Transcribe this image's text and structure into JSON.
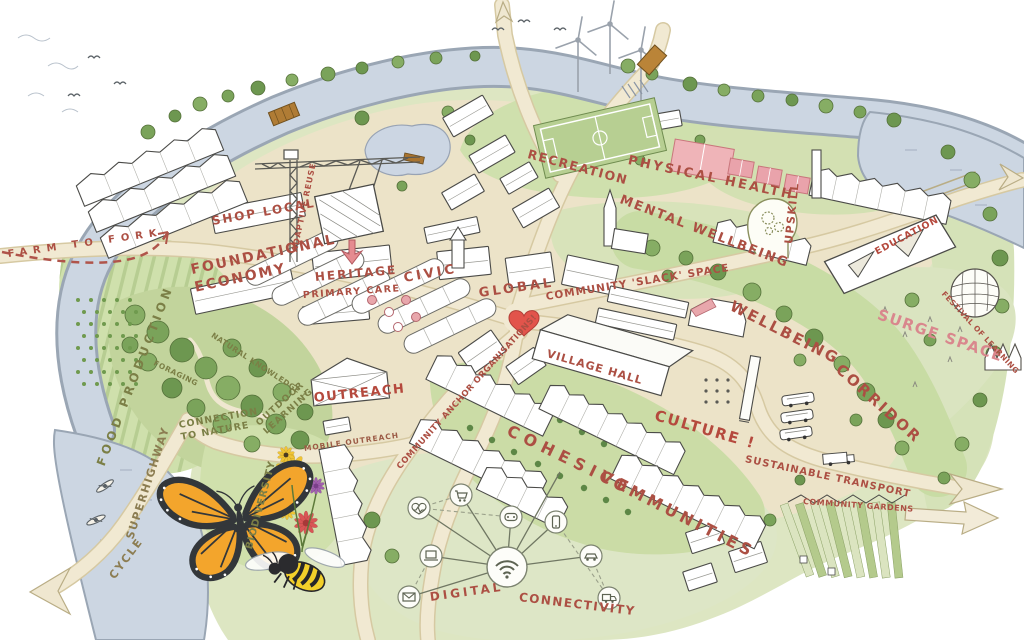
{
  "labels": {
    "farm_to_fork": {
      "text": "FARM TO FORK"
    },
    "food_production": {
      "text": "FOOD PRODUCTION"
    },
    "foundational_economy": {
      "line1": "FOUNDATIONAL",
      "line2": "ECONOMY"
    },
    "shop_local": {
      "text": "SHOP LOCAL"
    },
    "adaptive_reuse": {
      "text": "ADAPTIVE REUSE"
    },
    "heritage": {
      "text": "HERITAGE"
    },
    "primary_care": {
      "text": "PRIMARY CARE"
    },
    "civic": {
      "text": "CIVIC"
    },
    "global": {
      "text": "GLOBAL"
    },
    "community_slack_space": {
      "text": "COMMUNITY 'SLACK' SPACE"
    },
    "recreation": {
      "text": "RECREATION"
    },
    "physical_health": {
      "text": "PHYSICAL HEALTH"
    },
    "mental_wellbeing": {
      "text": "MENTAL WELLBEING"
    },
    "upskill": {
      "text": "UPSKILL"
    },
    "education": {
      "text": "EDUCATION"
    },
    "surge_space": {
      "text": "SURGE SPACE"
    },
    "festival_of_learning": {
      "text": "FESTIVAL OF LEARNING"
    },
    "wellbeing_corridor": {
      "word1": "WELLBEING",
      "word2": "CORRIDOR"
    },
    "culture": {
      "text": "CULTURE !"
    },
    "sustainable_transport": {
      "text": "SUSTAINABLE TRANSPORT"
    },
    "community_gardens": {
      "text": "COMMUNITY GARDENS"
    },
    "village_hall": {
      "text": "VILLAGE HALL"
    },
    "community_anchor_organisations": {
      "text": "COMMUNITY ANCHOR ORGANISATIONS!"
    },
    "cohesive_communities": {
      "word1": "COHESIVE",
      "word2": "COMMUNITIES"
    },
    "outreach": {
      "text": "OUTREACH"
    },
    "mobile_outreach": {
      "text": "MOBILE OUTREACH"
    },
    "outdoor_learning": {
      "line1": "OUTDOOR",
      "line2": "LEARNING"
    },
    "connection_to_nature": {
      "line1": "CONNECTION",
      "line2": "TO NATURE"
    },
    "natural_knowledge": {
      "text": "NATURAL KNOWLEDGE ?"
    },
    "foraging": {
      "text": "FORAGING"
    },
    "biodiversity": {
      "text": "BIODIVERSITY"
    },
    "cycle_superhighway": {
      "word1": "CYCLE",
      "word2": "SUPERHIGHWAY"
    },
    "digital_connectivity": {
      "word1": "DIGITAL",
      "word2": "CONNECTIVITY"
    }
  },
  "palette": {
    "label_red": "#ac4f43",
    "label_pink": "#d9878d",
    "label_olive": "#7b7f46",
    "label_tan": "#8c7d52",
    "river": "#ccd6e2",
    "land": "#ece3c8",
    "grass": "#d5e1b8",
    "woodland": "#6f9850",
    "court_pink": "#efb4b8",
    "heart_red": "#e2544b",
    "butterfly_orange": "#f3a52c",
    "bee_yellow": "#f2cf2a"
  },
  "icons": {
    "wind_turbines": "wind-turbine-icon",
    "butterfly": "butterfly-icon",
    "bee": "bee-icon",
    "flowers": "flower-icon",
    "heart": "heart-icon",
    "head_gears": "head-gears-icon",
    "dome": "geodesic-dome-icon",
    "crane": "construction-crane-icon",
    "network_hub": "wifi-icon",
    "network_nodes": [
      "health-icon",
      "shopping-cart-icon",
      "game-controller-icon",
      "smartphone-icon",
      "laptop-icon",
      "car-icon",
      "mail-icon",
      "delivery-truck-icon"
    ]
  }
}
